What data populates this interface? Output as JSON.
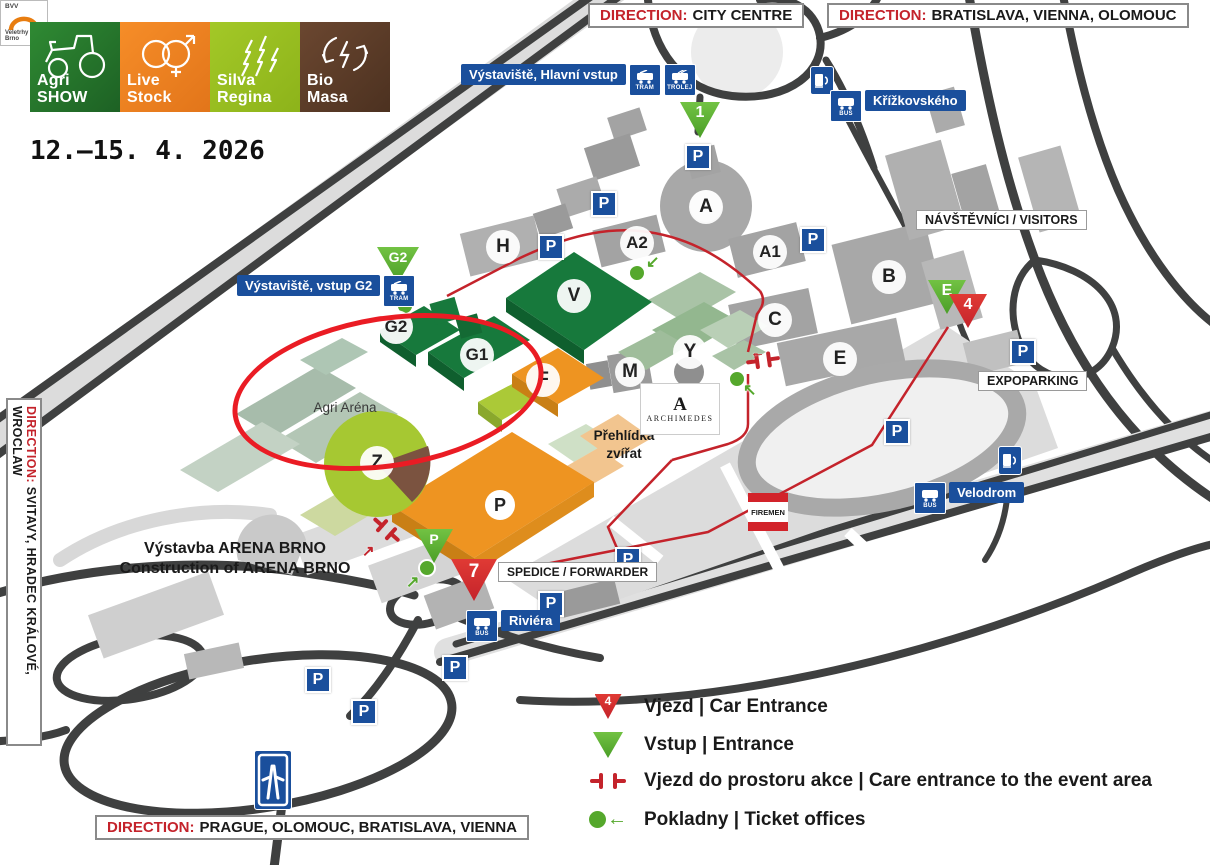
{
  "event": {
    "logos": [
      {
        "line1": "Agri",
        "line2": "SHOW"
      },
      {
        "line1": "Live",
        "line2": "Stock"
      },
      {
        "line1": "Silva",
        "line2": "Regina"
      },
      {
        "line1": "Bio",
        "line2": "Masa"
      }
    ],
    "date": "12.–15. 4. 2026"
  },
  "directions": {
    "prefix": "DIRECTION:",
    "city_centre": "CITY CENTRE",
    "bratislava": "BRATISLAVA, VIENNA, OLOMOUC",
    "svitavy": "SVITAVY, HRADEC KRÁLOVÉ, WROCLAW",
    "prague": "PRAGUE, OLOMOUC, BRATISLAVA, VIENNA"
  },
  "transit": {
    "main_entrance": "Výstaviště, Hlavní vstup",
    "g2_entrance": "Výstaviště, vstup G2",
    "krizkovskeho": "Křížkovského",
    "velodrom": "Velodrom",
    "riviera": "Riviéra",
    "tram": "TRAM",
    "trolej": "TROLEJ",
    "bus": "BUS"
  },
  "areas": {
    "visitors": "NÁVŠTĚVNÍCI / VISITORS",
    "expoparking": "EXPOPARKING",
    "spedice": "SPEDICE / FORWARDER",
    "firemen": "FIREMEN",
    "agri_arena": "Agri Aréna",
    "prehlidka_line1": "Přehlídka",
    "prehlidka_line2": "zvířat",
    "construction_cs": "Výstavba ARENA BRNO",
    "construction_en": "Construction of ARENA BRNO",
    "archimedes": "ARCHIMEDES",
    "bvv": "BVV",
    "bvv_name": "Veletrhy Brno"
  },
  "halls": [
    {
      "label": "H"
    },
    {
      "label": "A2"
    },
    {
      "label": "A"
    },
    {
      "label": "A1"
    },
    {
      "label": "B"
    },
    {
      "label": "C"
    },
    {
      "label": "E"
    },
    {
      "label": "Y"
    },
    {
      "label": "M"
    },
    {
      "label": "V"
    },
    {
      "label": "G2"
    },
    {
      "label": "G1"
    },
    {
      "label": "F"
    },
    {
      "label": "Z"
    }
  ],
  "markers": {
    "parking": "P",
    "entrance_1": "1",
    "entrance_g2": "G2",
    "entrance_e": "E",
    "entrance_p": "P",
    "car_4": "4",
    "car_7": "7"
  },
  "legend": {
    "car_badge": "4",
    "car_entrance": "Vjezd | Car Entrance",
    "entrance": "Vstup | Entrance",
    "event_area": "Vjezd do prostoru akce | Care entrance to the event area",
    "tickets": "Pokladny | Ticket offices"
  },
  "colors": {
    "red": "#c4232b",
    "blue": "#1a4f9c",
    "green": "#58ad2c",
    "hall_green": "#17793c",
    "orange": "#ee9421",
    "lime": "#a6c832",
    "brown": "#5a3a25"
  }
}
